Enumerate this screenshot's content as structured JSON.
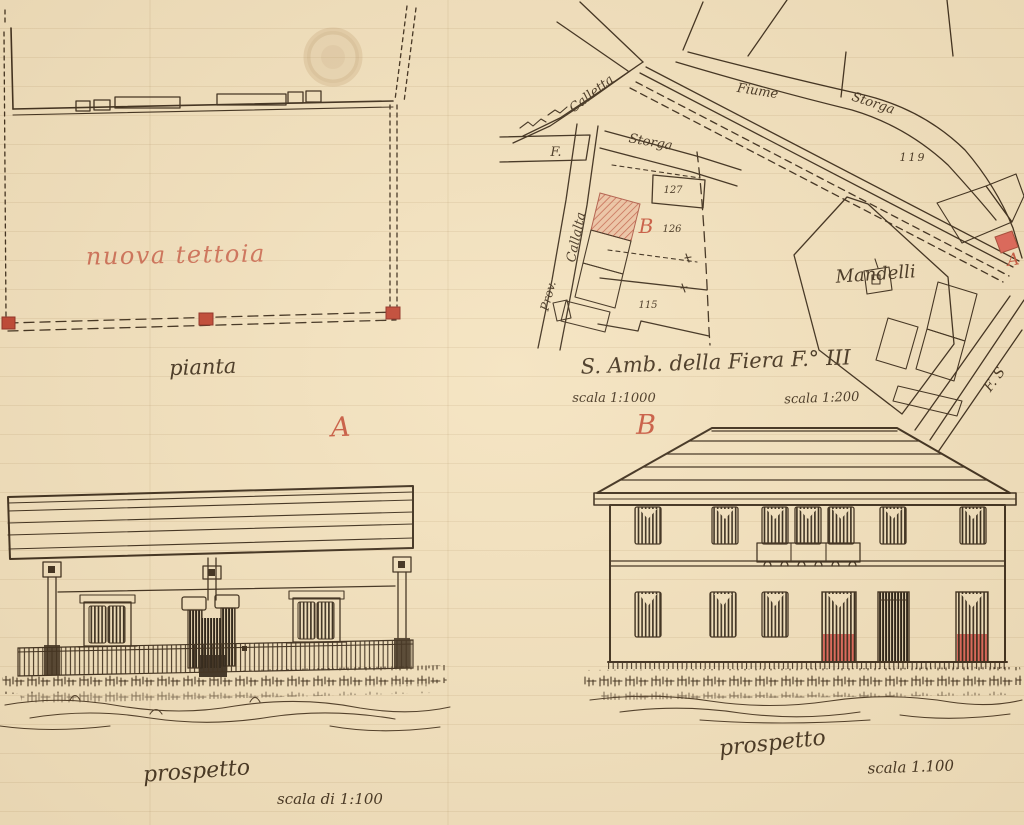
{
  "palette": {
    "paper": "#f4e3c0",
    "ink": "#3a2b1a",
    "red_ink": "#c8573f",
    "red_fill": "#e0665a"
  },
  "plan": {
    "new_canopy_label": "nuova tettoia",
    "caption": "pianta"
  },
  "map": {
    "caption": "S. Amb. della Fiera F.° III",
    "scale_1000": "scala 1:1000",
    "scale_200": "scala 1:200",
    "owner_label": "Mandelli",
    "marker_a": "A",
    "marker_b": "B",
    "road_calletta": "Calletta",
    "road_fiume": "Fiume",
    "river_storga": "Storga",
    "road_storga": "Storga",
    "road_prov": "Prov.",
    "road_callalta": "Callalta",
    "label_f": "F.",
    "label_fs": "F. S",
    "parcel_127": "127",
    "parcel_126": "126",
    "parcel_115": "115",
    "parcel_119": "119"
  },
  "elevation_a": {
    "marker": "A",
    "caption": "prospetto",
    "scale": "scala di 1:100"
  },
  "elevation_b": {
    "marker": "B",
    "caption": "prospetto",
    "scale": "scala 1.100"
  }
}
